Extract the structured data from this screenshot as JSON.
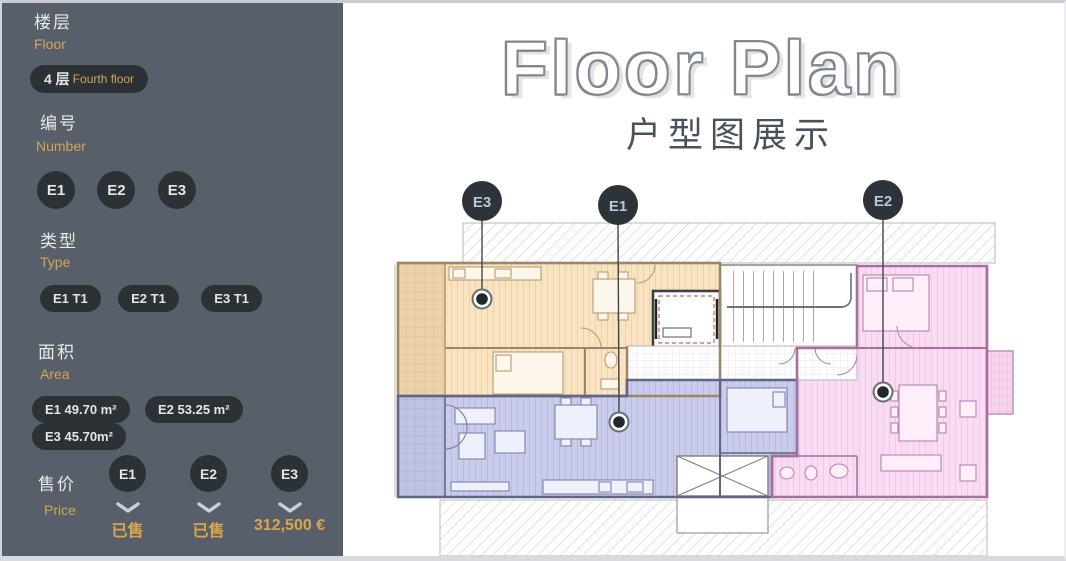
{
  "sidebar": {
    "floor": {
      "zh": "楼层",
      "en": "Floor",
      "selected_number": "4 层",
      "selected_name": "Fourth floor"
    },
    "number": {
      "zh": "编号",
      "en": "Number",
      "options": [
        "E1",
        "E2",
        "E3"
      ]
    },
    "type": {
      "zh": "类型",
      "en": "Type",
      "options": [
        "E1 T1",
        "E2 T1",
        "E3 T1"
      ]
    },
    "area": {
      "zh": "面积",
      "en": "Area",
      "options": [
        "E1 49.70 m²",
        "E2 53.25 m²",
        "E3 45.70m²"
      ]
    },
    "price": {
      "zh": "售价",
      "en": "Price",
      "items": [
        {
          "unit": "E1",
          "status": "已售"
        },
        {
          "unit": "E2",
          "status": "已售"
        },
        {
          "unit": "E3",
          "status": "312,500 €"
        }
      ]
    }
  },
  "main": {
    "title": "Floor Plan",
    "subtitle": "户型图展示",
    "markers": [
      {
        "id": "E3"
      },
      {
        "id": "E1"
      },
      {
        "id": "E2"
      }
    ]
  },
  "colors": {
    "sidebar_bg": "#57606a",
    "button_bg": "#2c3136",
    "accent_orange": "#d5a355",
    "unit_e3_fill": "#f8e3c2",
    "unit_e1_fill": "#c9cceb",
    "unit_e2_fill": "#f9dcf3"
  }
}
